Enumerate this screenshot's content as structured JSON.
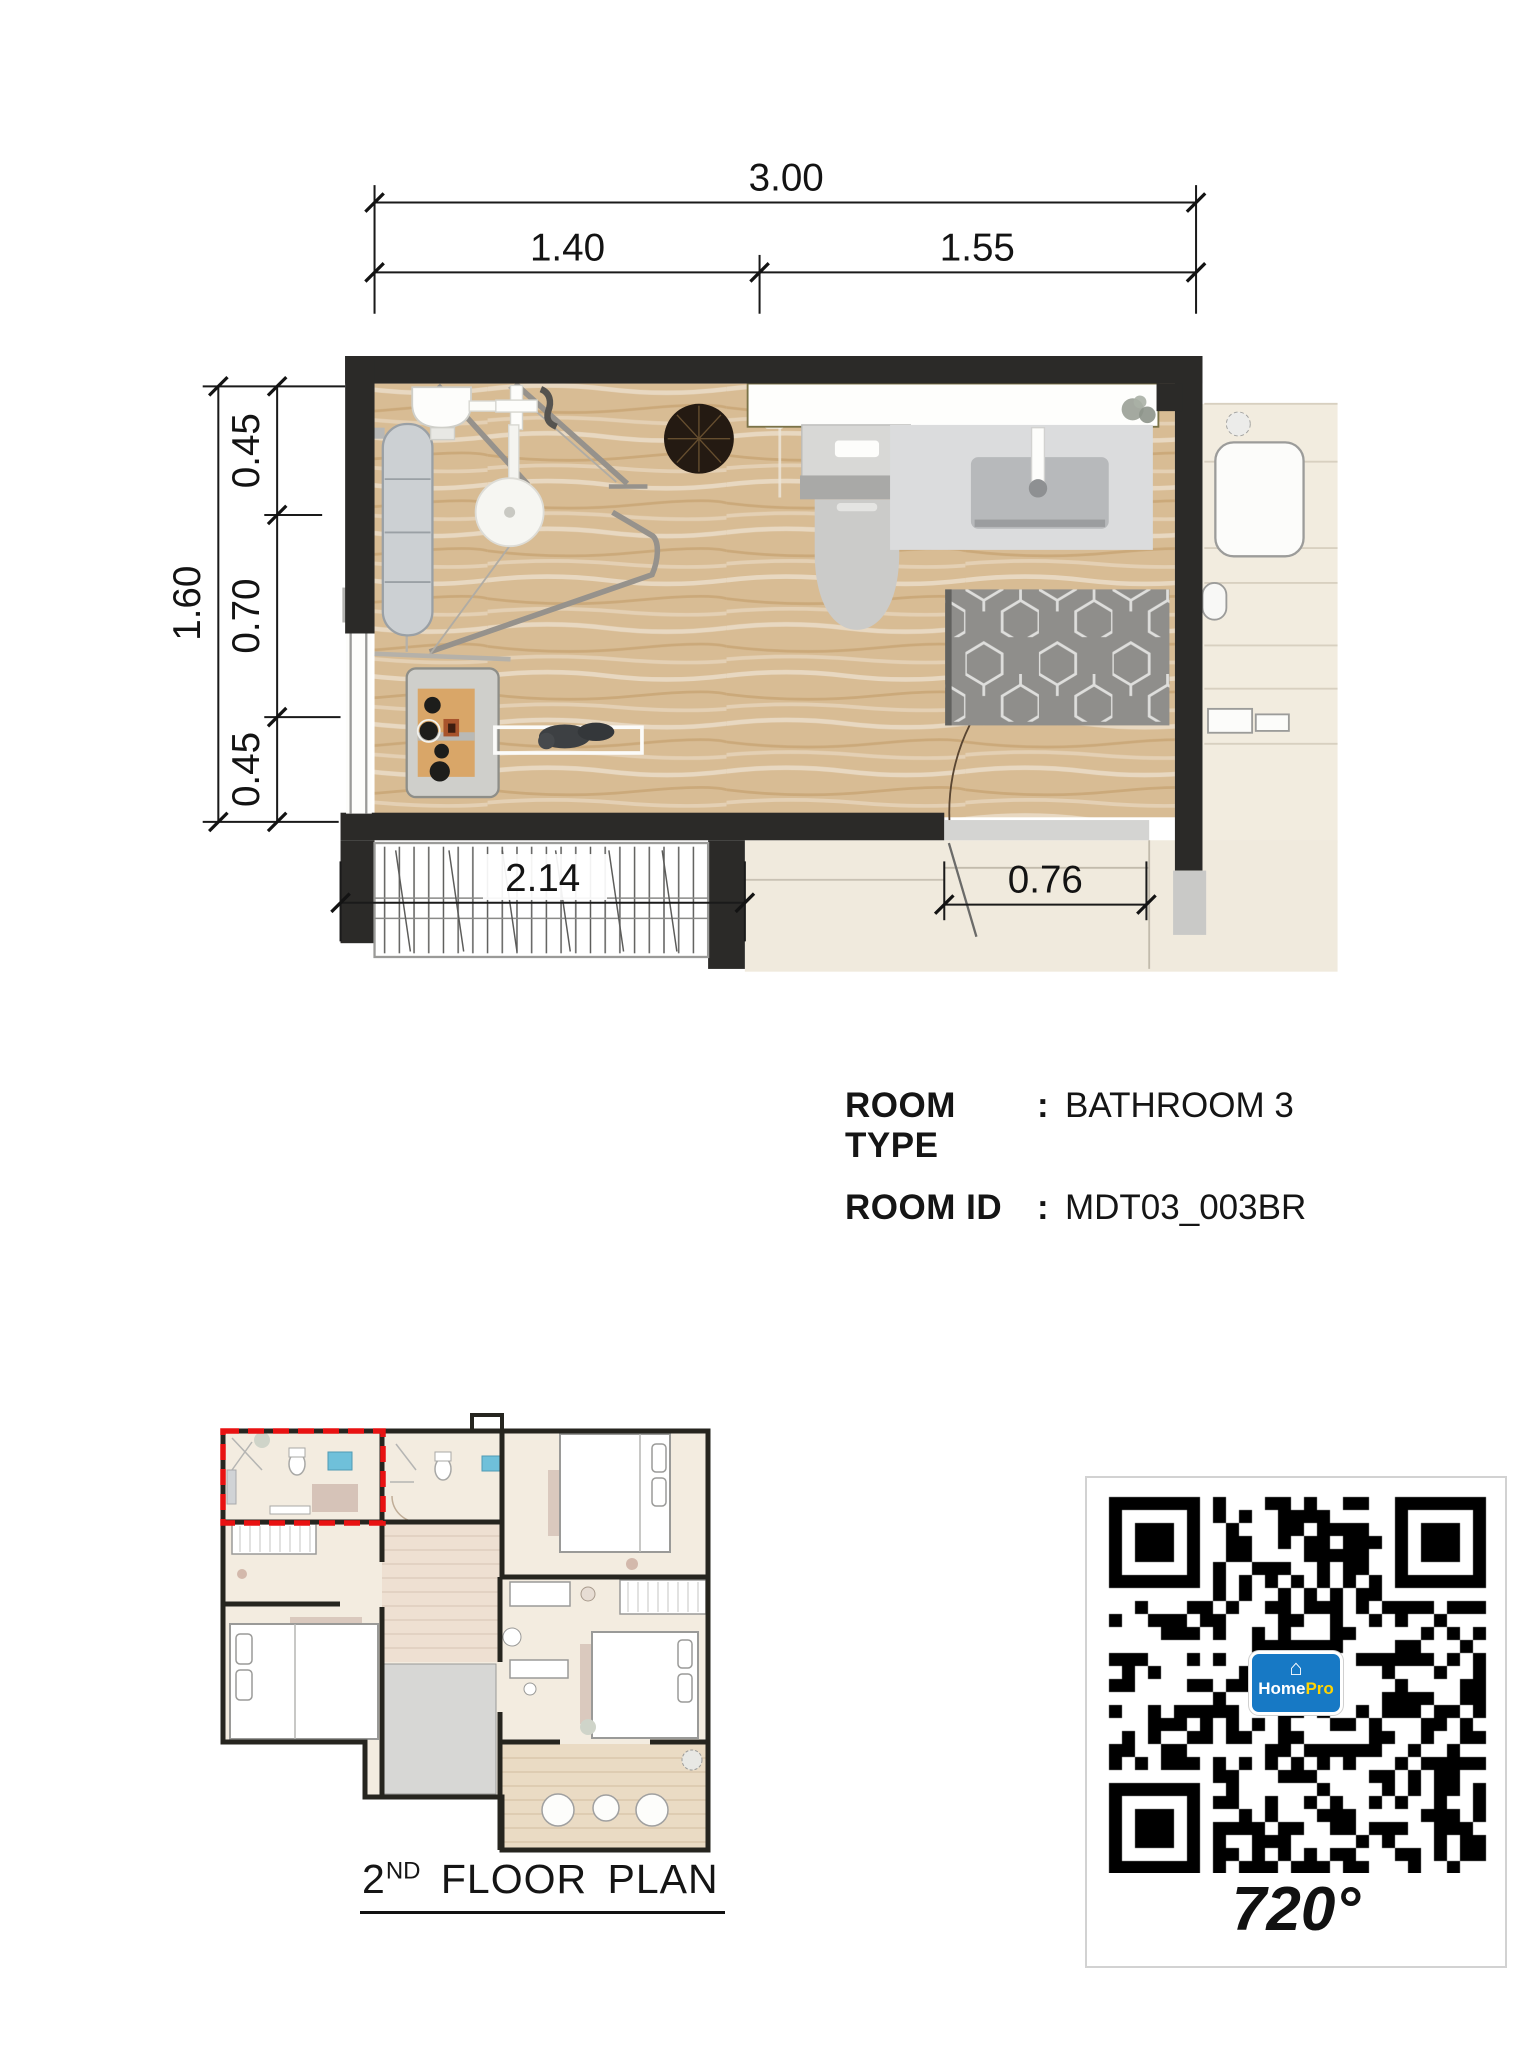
{
  "dimensions": {
    "top_overall": "3.00",
    "top_seg1": "1.40",
    "top_seg2": "1.55",
    "left_overall": "1.60",
    "left_seg1": "0.45",
    "left_seg2": "0.70",
    "left_seg3": "0.45",
    "closet_width": "2.14",
    "door_width": "0.76"
  },
  "room_info": {
    "rows": [
      {
        "label": "ROOM TYPE",
        "separator": ":",
        "value": "BATHROOM 3"
      },
      {
        "label": "ROOM ID",
        "separator": ":",
        "value": "MDT03_003BR"
      }
    ]
  },
  "thumbnail_caption": {
    "number": "2",
    "superscript": "ND",
    "rest": " FLOOR PLAN"
  },
  "qr": {
    "caption": "720°",
    "logo_house_glyph": "⌂",
    "logo_home": "Home",
    "logo_pro": "Pro"
  },
  "colors": {
    "wall": "#2b2a28",
    "wood_floor": "#d8bc94",
    "cream_floor": "#f2ecdf",
    "highlight_red": "#e81212",
    "logo_blue": "#1779c5",
    "logo_yellow": "#ffd400",
    "rug_gray": "#8f8e8b"
  }
}
